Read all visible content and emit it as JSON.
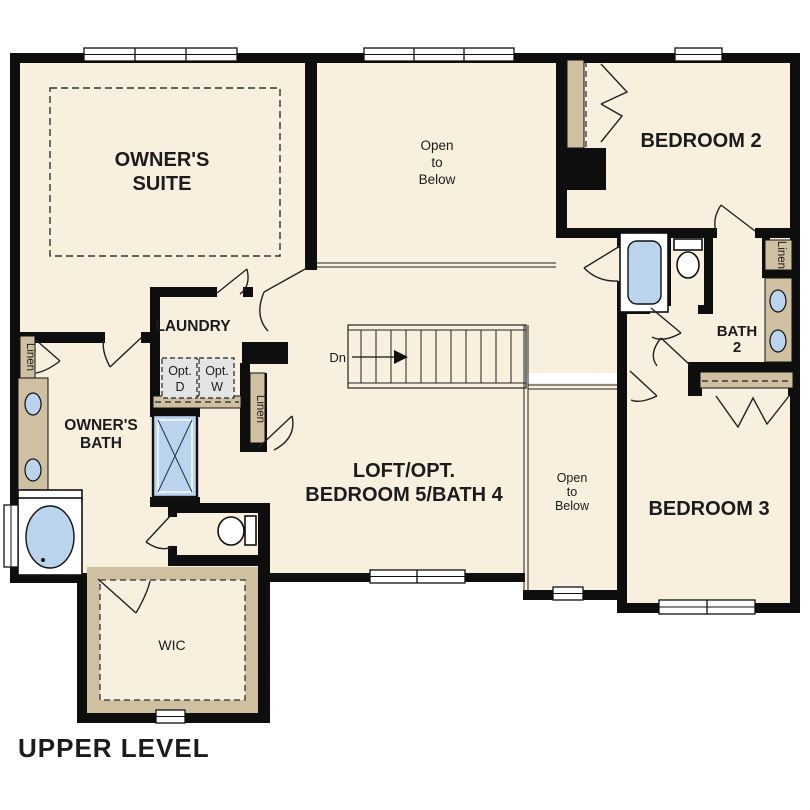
{
  "title": {
    "label": "UPPER LEVEL"
  },
  "colors": {
    "paper": "#ffffff",
    "floor": "#f8efde",
    "wall": "#0e0e0e",
    "tan": "#cec0a1",
    "blue": "#b9d4ec",
    "opt_gray": "#e4e4e4",
    "ink": "#1c1c1c"
  },
  "rooms": {
    "owners_suite": {
      "line1": "OWNER'S",
      "line2": "SUITE"
    },
    "open_to_below_main": {
      "line1": "Open",
      "line2": "to",
      "line3": "Below"
    },
    "bedroom_2": {
      "label": "BEDROOM 2"
    },
    "laundry": {
      "label": "LAUNDRY"
    },
    "owners_bath": {
      "line1": "OWNER'S",
      "line2": "BATH"
    },
    "loft": {
      "line1": "LOFT/OPT.",
      "line2": "BEDROOM 5/BATH 4"
    },
    "open_to_below_small": {
      "line1": "Open",
      "line2": "to",
      "line3": "Below"
    },
    "bedroom_3": {
      "label": "BEDROOM 3"
    },
    "bath_2": {
      "line1": "BATH",
      "line2": "2"
    },
    "wic": {
      "label": "WIC"
    }
  },
  "closets": {
    "linen_left": "Linen",
    "linen_center": "Linen",
    "linen_right": "Linen"
  },
  "laundry_appliances": {
    "dryer": {
      "line1": "Opt.",
      "line2": "D"
    },
    "washer": {
      "line1": "Opt.",
      "line2": "W"
    }
  },
  "stairs": {
    "down_label": "Dn"
  }
}
